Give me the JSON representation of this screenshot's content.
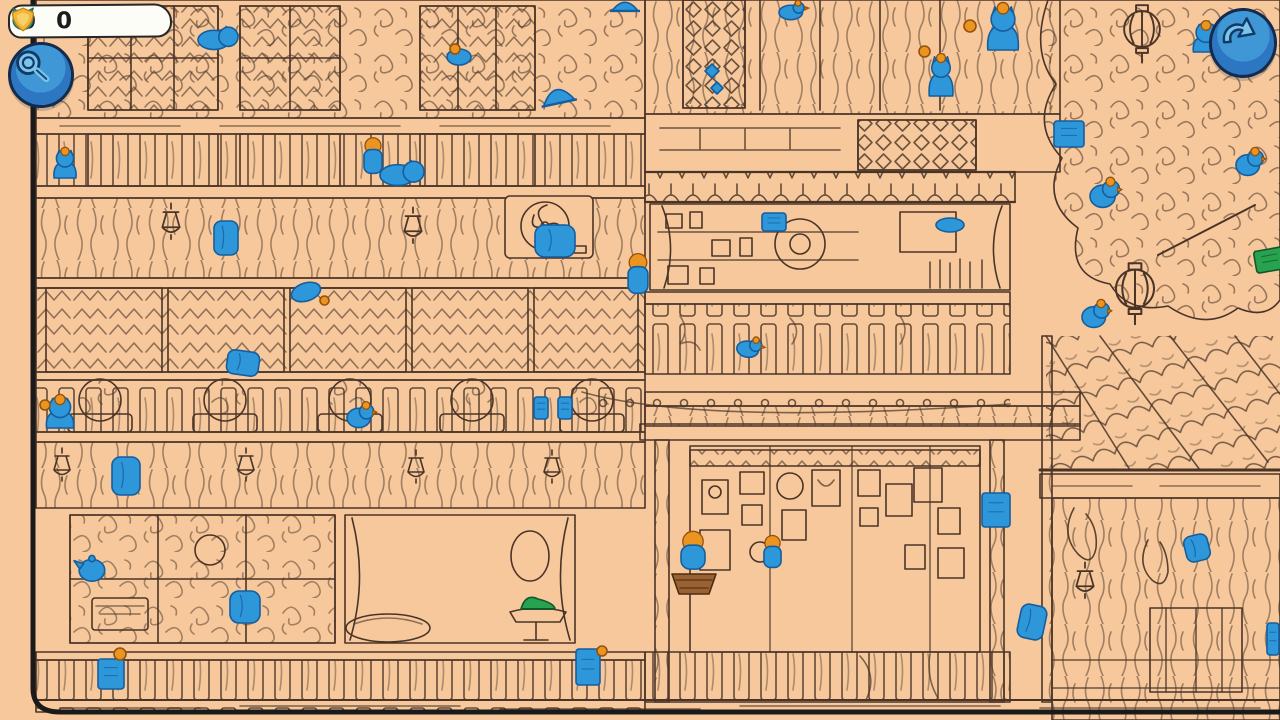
{
  "hud": {
    "cat_counter": {
      "icon": "cat-head",
      "value": "0"
    },
    "coin_counter": {
      "icon": "gold-badge",
      "value": "0"
    },
    "magnifier_button": {
      "icon": "magnifying-glass"
    },
    "undo_button": {
      "icon": "undo-arrow"
    }
  },
  "colors": {
    "background": "#f6c89b",
    "line_art": "#4a3428",
    "card_border": "#1a1a1a",
    "hidden_object_blue": "#2e97d9",
    "hidden_object_blue_outline": "#155e9e",
    "accent_orange": "#eb9420",
    "accent_green": "#27a24f",
    "basket_brown": "#9a6132",
    "button_blue": "#2d77c2",
    "counter_teal": "#38a695",
    "counter_gold": "#f2b63a"
  },
  "scene": {
    "description": "Hand-drawn hidden-object street scene of a multi-story shophouse with tree, lanterns and tiled roof; blue hidden objects scattered throughout",
    "items": [
      {
        "name": "hidden-cat-lying",
        "shape": "cat-lying",
        "x": 198,
        "y": 26,
        "w": 38,
        "h": 24
      },
      {
        "name": "hidden-bundle",
        "shape": "blob",
        "x": 446,
        "y": 48,
        "w": 26,
        "h": 18
      },
      {
        "name": "hidden-cap",
        "shape": "cap",
        "x": 540,
        "y": 86,
        "w": 36,
        "h": 22,
        "rot": -12
      },
      {
        "name": "hidden-person",
        "shape": "person",
        "x": 363,
        "y": 140,
        "w": 20,
        "h": 34
      },
      {
        "name": "hidden-cat-lying",
        "shape": "cat-lying",
        "x": 380,
        "y": 160,
        "w": 42,
        "h": 26
      },
      {
        "name": "hidden-cat",
        "shape": "cat-sit",
        "x": 52,
        "y": 150,
        "w": 26,
        "h": 28
      },
      {
        "name": "hidden-jacket",
        "shape": "cloth",
        "x": 534,
        "y": 224,
        "w": 42,
        "h": 34
      },
      {
        "name": "hidden-robe",
        "shape": "cloth",
        "x": 213,
        "y": 220,
        "w": 26,
        "h": 36
      },
      {
        "name": "hidden-fish",
        "shape": "blob",
        "x": 290,
        "y": 282,
        "w": 32,
        "h": 20,
        "rot": -18
      },
      {
        "name": "hidden-cloth",
        "shape": "cloth",
        "x": 226,
        "y": 350,
        "w": 34,
        "h": 26,
        "rot": 8
      },
      {
        "name": "hidden-bird",
        "shape": "bird",
        "x": 779,
        "y": 2,
        "w": 28,
        "h": 18
      },
      {
        "name": "hidden-cat",
        "shape": "cat-sit",
        "x": 985,
        "y": 6,
        "w": 36,
        "h": 44
      },
      {
        "name": "hidden-diamond",
        "shape": "diamond",
        "x": 705,
        "y": 64,
        "w": 14,
        "h": 14
      },
      {
        "name": "hidden-diamond",
        "shape": "diamond",
        "x": 711,
        "y": 82,
        "w": 12,
        "h": 12
      },
      {
        "name": "hidden-cat",
        "shape": "cat-sit",
        "x": 927,
        "y": 56,
        "w": 28,
        "h": 40
      },
      {
        "name": "hidden-cat",
        "shape": "cat-sit",
        "x": 1191,
        "y": 24,
        "w": 30,
        "h": 28
      },
      {
        "name": "hidden-screen",
        "shape": "rect",
        "x": 1053,
        "y": 120,
        "w": 32,
        "h": 28
      },
      {
        "name": "hidden-bird",
        "shape": "bird",
        "x": 1236,
        "y": 150,
        "w": 28,
        "h": 26
      },
      {
        "name": "hidden-bird",
        "shape": "bird",
        "x": 1090,
        "y": 180,
        "w": 30,
        "h": 28
      },
      {
        "name": "hidden-box",
        "shape": "rect",
        "x": 761,
        "y": 212,
        "w": 26,
        "h": 20
      },
      {
        "name": "hidden-item",
        "shape": "blob",
        "x": 935,
        "y": 217,
        "w": 30,
        "h": 16
      },
      {
        "name": "hidden-book",
        "shape": "rect",
        "x": 1254,
        "y": 248,
        "w": 32,
        "h": 24,
        "rot": -10,
        "color": "green"
      },
      {
        "name": "hidden-person",
        "shape": "person",
        "x": 627,
        "y": 256,
        "w": 22,
        "h": 38
      },
      {
        "name": "hidden-bird",
        "shape": "bird",
        "x": 1082,
        "y": 302,
        "w": 28,
        "h": 26
      },
      {
        "name": "hidden-cup",
        "shape": "bird",
        "x": 737,
        "y": 338,
        "w": 26,
        "h": 20,
        "rot": 10
      },
      {
        "name": "hidden-cat",
        "shape": "cat-sit",
        "x": 44,
        "y": 398,
        "w": 32,
        "h": 30
      },
      {
        "name": "hidden-bird",
        "shape": "bird",
        "x": 347,
        "y": 404,
        "w": 28,
        "h": 24
      },
      {
        "name": "hidden-tag",
        "shape": "rect",
        "x": 533,
        "y": 396,
        "w": 16,
        "h": 24
      },
      {
        "name": "hidden-tag",
        "shape": "rect",
        "x": 557,
        "y": 396,
        "w": 16,
        "h": 24
      },
      {
        "name": "hidden-robe",
        "shape": "cloth",
        "x": 111,
        "y": 456,
        "w": 30,
        "h": 40
      },
      {
        "name": "hidden-teapot",
        "shape": "teapot",
        "x": 74,
        "y": 556,
        "w": 32,
        "h": 26
      },
      {
        "name": "hidden-shirt",
        "shape": "cloth",
        "x": 229,
        "y": 590,
        "w": 32,
        "h": 34
      },
      {
        "name": "hidden-shoe",
        "shape": "shoe",
        "x": 520,
        "y": 592,
        "w": 36,
        "h": 20,
        "color": "green"
      },
      {
        "name": "hidden-box",
        "shape": "rect",
        "x": 97,
        "y": 658,
        "w": 28,
        "h": 32
      },
      {
        "name": "hidden-box",
        "shape": "rect",
        "x": 575,
        "y": 648,
        "w": 26,
        "h": 38
      },
      {
        "name": "hidden-person-basket",
        "shape": "person-basket",
        "x": 678,
        "y": 536,
        "w": 30,
        "h": 46
      },
      {
        "name": "hidden-person",
        "shape": "person",
        "x": 763,
        "y": 538,
        "w": 19,
        "h": 30
      },
      {
        "name": "hidden-book",
        "shape": "rect",
        "x": 981,
        "y": 492,
        "w": 30,
        "h": 36
      },
      {
        "name": "hidden-cloth",
        "shape": "cloth",
        "x": 1184,
        "y": 534,
        "w": 26,
        "h": 28,
        "rot": -14
      },
      {
        "name": "hidden-cloth",
        "shape": "cloth",
        "x": 1018,
        "y": 604,
        "w": 28,
        "h": 36,
        "rot": 12
      },
      {
        "name": "hidden-box",
        "shape": "rect",
        "x": 1266,
        "y": 622,
        "w": 14,
        "h": 34
      },
      {
        "name": "hidden-cap",
        "shape": "cap",
        "x": 610,
        "y": 0,
        "w": 30,
        "h": 14
      },
      {
        "name": "orange-ball",
        "shape": "dot",
        "x": 450,
        "y": 44,
        "w": 10,
        "h": 10,
        "color": "orange"
      },
      {
        "name": "orange-ball",
        "shape": "dot",
        "x": 964,
        "y": 20,
        "w": 12,
        "h": 12,
        "color": "orange"
      },
      {
        "name": "orange-ball",
        "shape": "dot",
        "x": 114,
        "y": 648,
        "w": 12,
        "h": 12,
        "color": "orange"
      },
      {
        "name": "orange-ball",
        "shape": "dot",
        "x": 597,
        "y": 646,
        "w": 10,
        "h": 10,
        "color": "orange"
      },
      {
        "name": "orange-ball",
        "shape": "dot",
        "x": 919,
        "y": 46,
        "w": 11,
        "h": 11,
        "color": "orange"
      },
      {
        "name": "orange-ball",
        "shape": "dot",
        "x": 40,
        "y": 400,
        "w": 10,
        "h": 10,
        "color": "orange"
      },
      {
        "name": "orange-ball",
        "shape": "dot",
        "x": 320,
        "y": 296,
        "w": 9,
        "h": 9,
        "color": "orange"
      }
    ]
  }
}
